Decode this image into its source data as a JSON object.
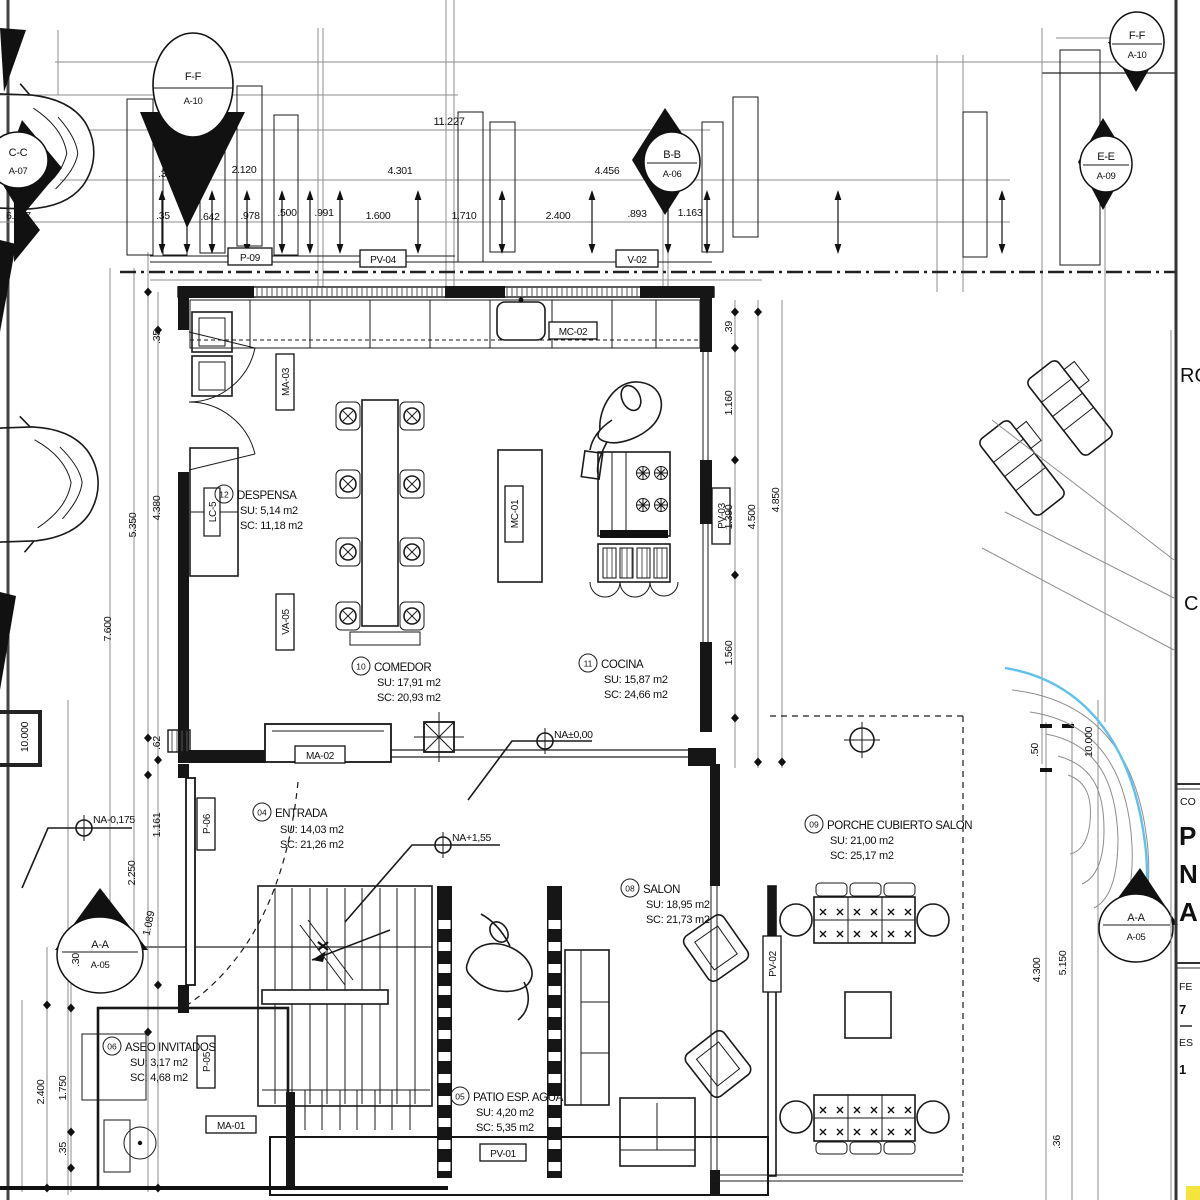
{
  "drawing_type": "architectural-floor-plan",
  "rooms": [
    {
      "num": "12",
      "name": "DESPENSA",
      "su": "SU: 5,14 m2",
      "sc": "SC: 11,18 m2"
    },
    {
      "num": "10",
      "name": "COMEDOR",
      "su": "SU: 17,91 m2",
      "sc": "SC: 20,93 m2"
    },
    {
      "num": "11",
      "name": "COCINA",
      "su": "SU: 15,87 m2",
      "sc": "SC: 24,66 m2"
    },
    {
      "num": "04",
      "name": "ENTRADA",
      "su": "SU: 14,03 m2",
      "sc": "SC: 21,26 m2"
    },
    {
      "num": "08",
      "name": "SALON",
      "su": "SU: 18,95 m2",
      "sc": "SC: 21,73 m2"
    },
    {
      "num": "09",
      "name": "PORCHE CUBIERTO SALON",
      "su": "SU: 21,00 m2",
      "sc": "SC: 25,17 m2"
    },
    {
      "num": "06",
      "name": "ASEO INVITADOS",
      "su": "SU: 3,17 m2",
      "sc": "SC: 4,68 m2"
    },
    {
      "num": "05",
      "name": "PATIO ESP. AGUA",
      "su": "SU: 4,20 m2",
      "sc": "SC: 5,35 m2"
    }
  ],
  "markers": [
    {
      "s": "F-F",
      "a": "A-10"
    },
    {
      "s": "F-F",
      "a": "A-10"
    },
    {
      "s": "C-C",
      "a": "A-07"
    },
    {
      "s": "B-B",
      "a": "A-06"
    },
    {
      "s": "E-E",
      "a": "A-09"
    },
    {
      "s": "A-A",
      "a": "A-05"
    },
    {
      "s": "A-A",
      "a": "A-05"
    }
  ],
  "levels": {
    "zero": "NA±0,00",
    "upper": "NA+1,55",
    "minus": "NA-0,175"
  },
  "tags": {
    "p09": "P-09",
    "pv04": "PV-04",
    "v02": "V-02",
    "mc02": "MC-02",
    "mc01": "MC-01",
    "ma03": "MA-03",
    "va05": "VA-05",
    "lc5": "LC-5",
    "pv03": "PV-03",
    "ma02": "MA-02",
    "p06": "P-06",
    "p05": "P-05",
    "ma01": "MA-01",
    "pv01": "PV-01",
    "pv02": "PV-02"
  },
  "dims": {
    "top": [
      "11.227",
      "2.120",
      "4.301",
      "4.456",
      "6.167",
      ".35",
      ".35",
      ".642",
      ".978",
      ".500",
      ".991",
      "1.600",
      "1.710",
      "2.400",
      ".893",
      "1.163"
    ],
    "left": [
      ".35",
      "4.380",
      "5.350",
      "7.600",
      "10.000",
      ".62",
      "1.161",
      "2.250",
      "1.089",
      ".30",
      "2.400",
      "1.750",
      ".35"
    ],
    "right": [
      ".39",
      "1.160",
      "1.390",
      "4.500",
      "4.850",
      "1.560",
      ".50",
      "10.000",
      "4.300",
      "5.150",
      ".36"
    ]
  },
  "title_block": {
    "ro": "RO",
    "c": "C",
    "co": "CO",
    "p": "P",
    "n": "N",
    "a": "A",
    "fe": "FE",
    "n7": "7",
    "es": "ES",
    "n1": "1"
  },
  "colors": {
    "line": "#1a1a1a",
    "gray": "#8d8d8d",
    "pool_blue": "#5fc1ec",
    "highlight_yellow": "#f3e53d"
  }
}
